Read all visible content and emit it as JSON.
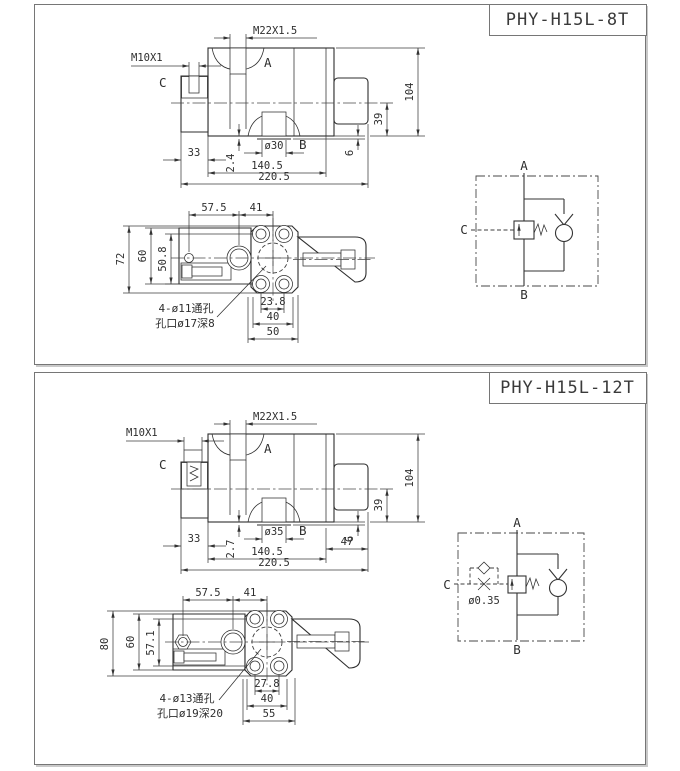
{
  "s1": {
    "model": "PHY-H15L-8T",
    "front": {
      "thread_top": "M22X1.5",
      "thread_side": "M10X1",
      "port_top": "A",
      "port_bottom": "B",
      "port_side": "C",
      "dim_height": "104",
      "dim_b_face": "39",
      "dim_base": "6",
      "dim_side_width": "33",
      "dim_lip": "2.4",
      "dim_bore": "ø30",
      "dim_body_length": "140.5",
      "dim_overall_length": "220.5"
    },
    "plan": {
      "dim_x1": "57.5",
      "dim_x2": "41",
      "dim_height": "72",
      "dim_body": "60",
      "dim_holes": "50.8",
      "dim_b1": "23.8",
      "dim_b2": "40",
      "dim_b3": "50",
      "note1": "4-ø11通孔",
      "note2": "孔口ø17深8"
    },
    "sch": {
      "port_top": "A",
      "port_bottom": "B",
      "port_side": "C"
    }
  },
  "s2": {
    "model": "PHY-H15L-12T",
    "front": {
      "thread_top": "M22X1.5",
      "thread_side": "M10X1",
      "port_top": "A",
      "port_bottom": "B",
      "port_side": "C",
      "dim_height": "104",
      "dim_b_face": "39",
      "dim_base": "6",
      "dim_side_width": "33",
      "dim_lip": "2.7",
      "dim_bore": "ø35",
      "dim_right": "47",
      "dim_body_length": "140.5",
      "dim_overall_length": "220.5"
    },
    "plan": {
      "dim_x1": "57.5",
      "dim_x2": "41",
      "dim_height": "80",
      "dim_body": "60",
      "dim_holes": "57.1",
      "dim_b1": "27.8",
      "dim_b2": "40",
      "dim_b3": "55",
      "note1": "4-ø13通孔",
      "note2": "孔口ø19深20"
    },
    "sch": {
      "port_top": "A",
      "port_bottom": "B",
      "port_side": "C",
      "orifice": "ø0.35"
    }
  }
}
